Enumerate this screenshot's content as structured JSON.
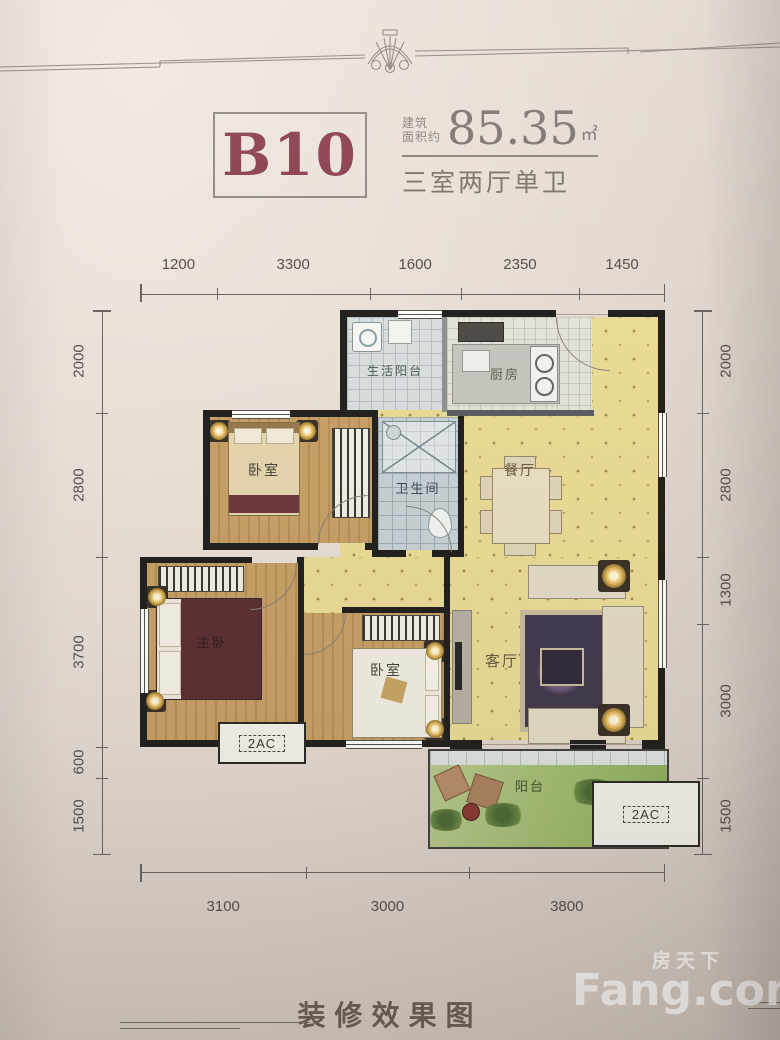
{
  "page": {
    "unit_code": "B10",
    "area_label_line1": "建筑",
    "area_label_line2": "面积约",
    "area_value": "85.35",
    "area_unit": "㎡",
    "layout_type": "三室两厅单卫",
    "caption": "装修效果图"
  },
  "dimensions": {
    "top": [
      "1200",
      "3300",
      "1600",
      "2350",
      "1450"
    ],
    "left": [
      "2000",
      "2800",
      "3700",
      "600",
      "1500"
    ],
    "right": [
      "2000",
      "2800",
      "1300",
      "3000",
      "1500"
    ],
    "bottom": [
      "3100",
      "3000",
      "3800"
    ]
  },
  "rooms": {
    "service_balcony": "生活阳台",
    "kitchen": "厨房",
    "bedroom_top": "卧室",
    "bathroom": "卫生间",
    "dining": "餐厅",
    "master_bedroom": "主卧",
    "bedroom_mid": "卧室",
    "living_room": "客厅",
    "balcony": "阳台"
  },
  "ac_platforms": {
    "left_label": "2AC",
    "right_label": "2AC"
  },
  "watermark": {
    "cn": "房天下",
    "en": "Fang.com"
  },
  "colors": {
    "accent_red": "#8d4150",
    "page_bg": "#e7ddd4",
    "dim_line": "#56514b",
    "floor_wood": "#c29a62",
    "floor_yellow": "#eadc96",
    "floor_tile": "#c8d2d5",
    "grass": "#a8bf78",
    "wall_dark": "#23221f"
  }
}
